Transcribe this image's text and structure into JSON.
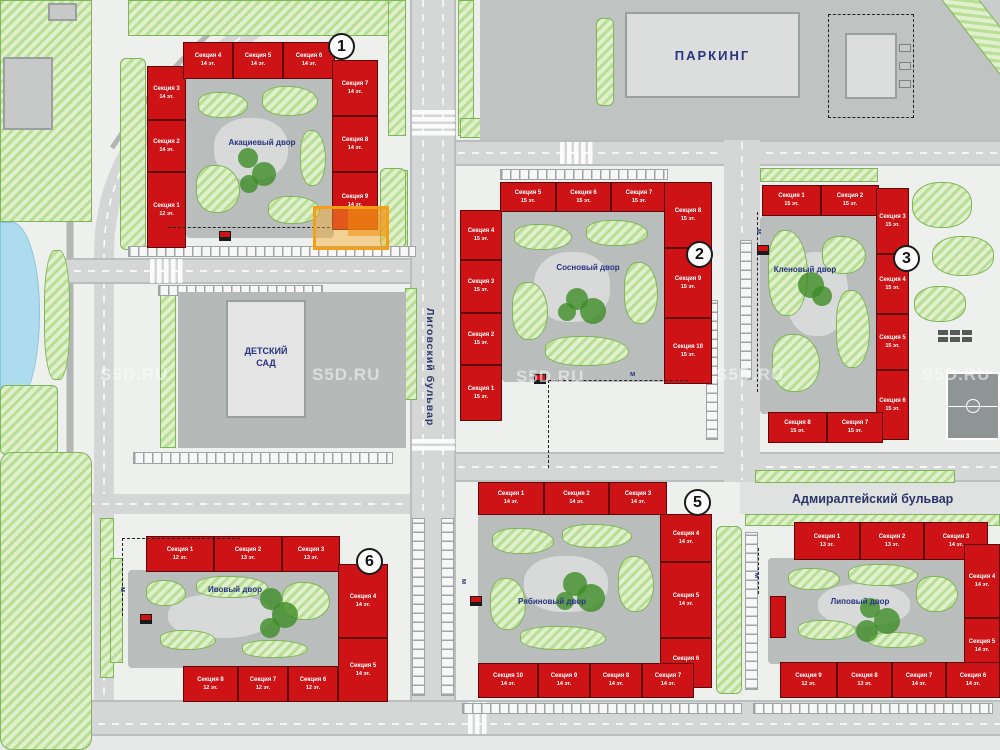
{
  "watermark": "S5D.RU",
  "streets": {
    "ligovsky": "Лиговский бульвар",
    "admiralteysky": "Адмиралтейский бульвар"
  },
  "pois": {
    "parking": "ПАРКИНГ",
    "kindergarten": "ДЕТСКИЙ САД"
  },
  "buildings": [
    {
      "badge": "1",
      "courtyard": "Акациевый двор",
      "sections": [
        {
          "name": "Секция 1",
          "floors": "12 эт."
        },
        {
          "name": "Секция 2",
          "floors": "14 эт."
        },
        {
          "name": "Секция 3",
          "floors": "14 эт."
        },
        {
          "name": "Секция 4",
          "floors": "14 эт."
        },
        {
          "name": "Секция 5",
          "floors": "14 эт."
        },
        {
          "name": "Секция 6",
          "floors": "14 эт."
        },
        {
          "name": "Секция 7",
          "floors": "14 эт."
        },
        {
          "name": "Секция 8",
          "floors": "14 эт."
        },
        {
          "name": "Секция 9",
          "floors": "14 эт."
        }
      ]
    },
    {
      "badge": "2",
      "courtyard": "Сосновый двор",
      "sections": [
        {
          "name": "Секция 1",
          "floors": "15 эт."
        },
        {
          "name": "Секция 2",
          "floors": "15 эт."
        },
        {
          "name": "Секция 3",
          "floors": "15 эт."
        },
        {
          "name": "Секция 4",
          "floors": "15 эт."
        },
        {
          "name": "Секция 5",
          "floors": "15 эт."
        },
        {
          "name": "Секция 6",
          "floors": "15 эт."
        },
        {
          "name": "Секция 7",
          "floors": "15 эт."
        },
        {
          "name": "Секция 8",
          "floors": "15 эт."
        },
        {
          "name": "Секция 9",
          "floors": "15 эт."
        },
        {
          "name": "Секция 10",
          "floors": "15 эт."
        }
      ]
    },
    {
      "badge": "3",
      "courtyard": "Кленовый двор",
      "sections": [
        {
          "name": "Секция 1",
          "floors": "15 эт."
        },
        {
          "name": "Секция 2",
          "floors": "15 эт."
        },
        {
          "name": "Секция 3",
          "floors": "15 эт."
        },
        {
          "name": "Секция 4",
          "floors": "15 эт."
        },
        {
          "name": "Секция 5",
          "floors": "15 эт."
        },
        {
          "name": "Секция 6",
          "floors": "15 эт."
        },
        {
          "name": "Секция 7",
          "floors": "15 эт."
        },
        {
          "name": "Секция 8",
          "floors": "15 эт."
        }
      ]
    },
    {
      "badge": "5",
      "courtyard": "Рябиновый двор",
      "sections": [
        {
          "name": "Секция 1",
          "floors": "14 эт."
        },
        {
          "name": "Секция 2",
          "floors": "14 эт."
        },
        {
          "name": "Секция 3",
          "floors": "14 эт."
        },
        {
          "name": "Секция 4",
          "floors": "14 эт."
        },
        {
          "name": "Секция 5",
          "floors": "14 эт."
        },
        {
          "name": "Секция 6",
          "floors": "14 эт."
        },
        {
          "name": "Секция 7",
          "floors": "14 эт."
        },
        {
          "name": "Секция 8",
          "floors": "14 эт."
        },
        {
          "name": "Секция 9",
          "floors": "14 эт."
        },
        {
          "name": "Секция 10",
          "floors": "14 эт."
        }
      ]
    },
    {
      "badge": "6",
      "courtyard": "Ивовый двор",
      "sections": [
        {
          "name": "Секция 1",
          "floors": "12 эт."
        },
        {
          "name": "Секция 2",
          "floors": "13 эт."
        },
        {
          "name": "Секция 3",
          "floors": "13 эт."
        },
        {
          "name": "Секция 4",
          "floors": "14 эт."
        },
        {
          "name": "Секция 5",
          "floors": "14 эт."
        },
        {
          "name": "Секция 6",
          "floors": "12 эт."
        },
        {
          "name": "Секция 7",
          "floors": "12 эт."
        },
        {
          "name": "Секция 8",
          "floors": "12 эт."
        }
      ]
    },
    {
      "badge": "",
      "courtyard": "Липовый двор",
      "sections": [
        {
          "name": "Секция 1",
          "floors": "13 эт."
        },
        {
          "name": "Секция 2",
          "floors": "13 эт."
        },
        {
          "name": "Секция 3",
          "floors": "14 эт."
        },
        {
          "name": "Секция 4",
          "floors": "14 эт."
        },
        {
          "name": "Секция 5",
          "floors": "14 эт."
        },
        {
          "name": "Секция 6",
          "floors": "14 эт."
        },
        {
          "name": "Секция 7",
          "floors": "14 эт."
        },
        {
          "name": "Секция 8",
          "floors": "13 эт."
        },
        {
          "name": "Секция 9",
          "floors": "12 эт."
        }
      ]
    }
  ]
}
